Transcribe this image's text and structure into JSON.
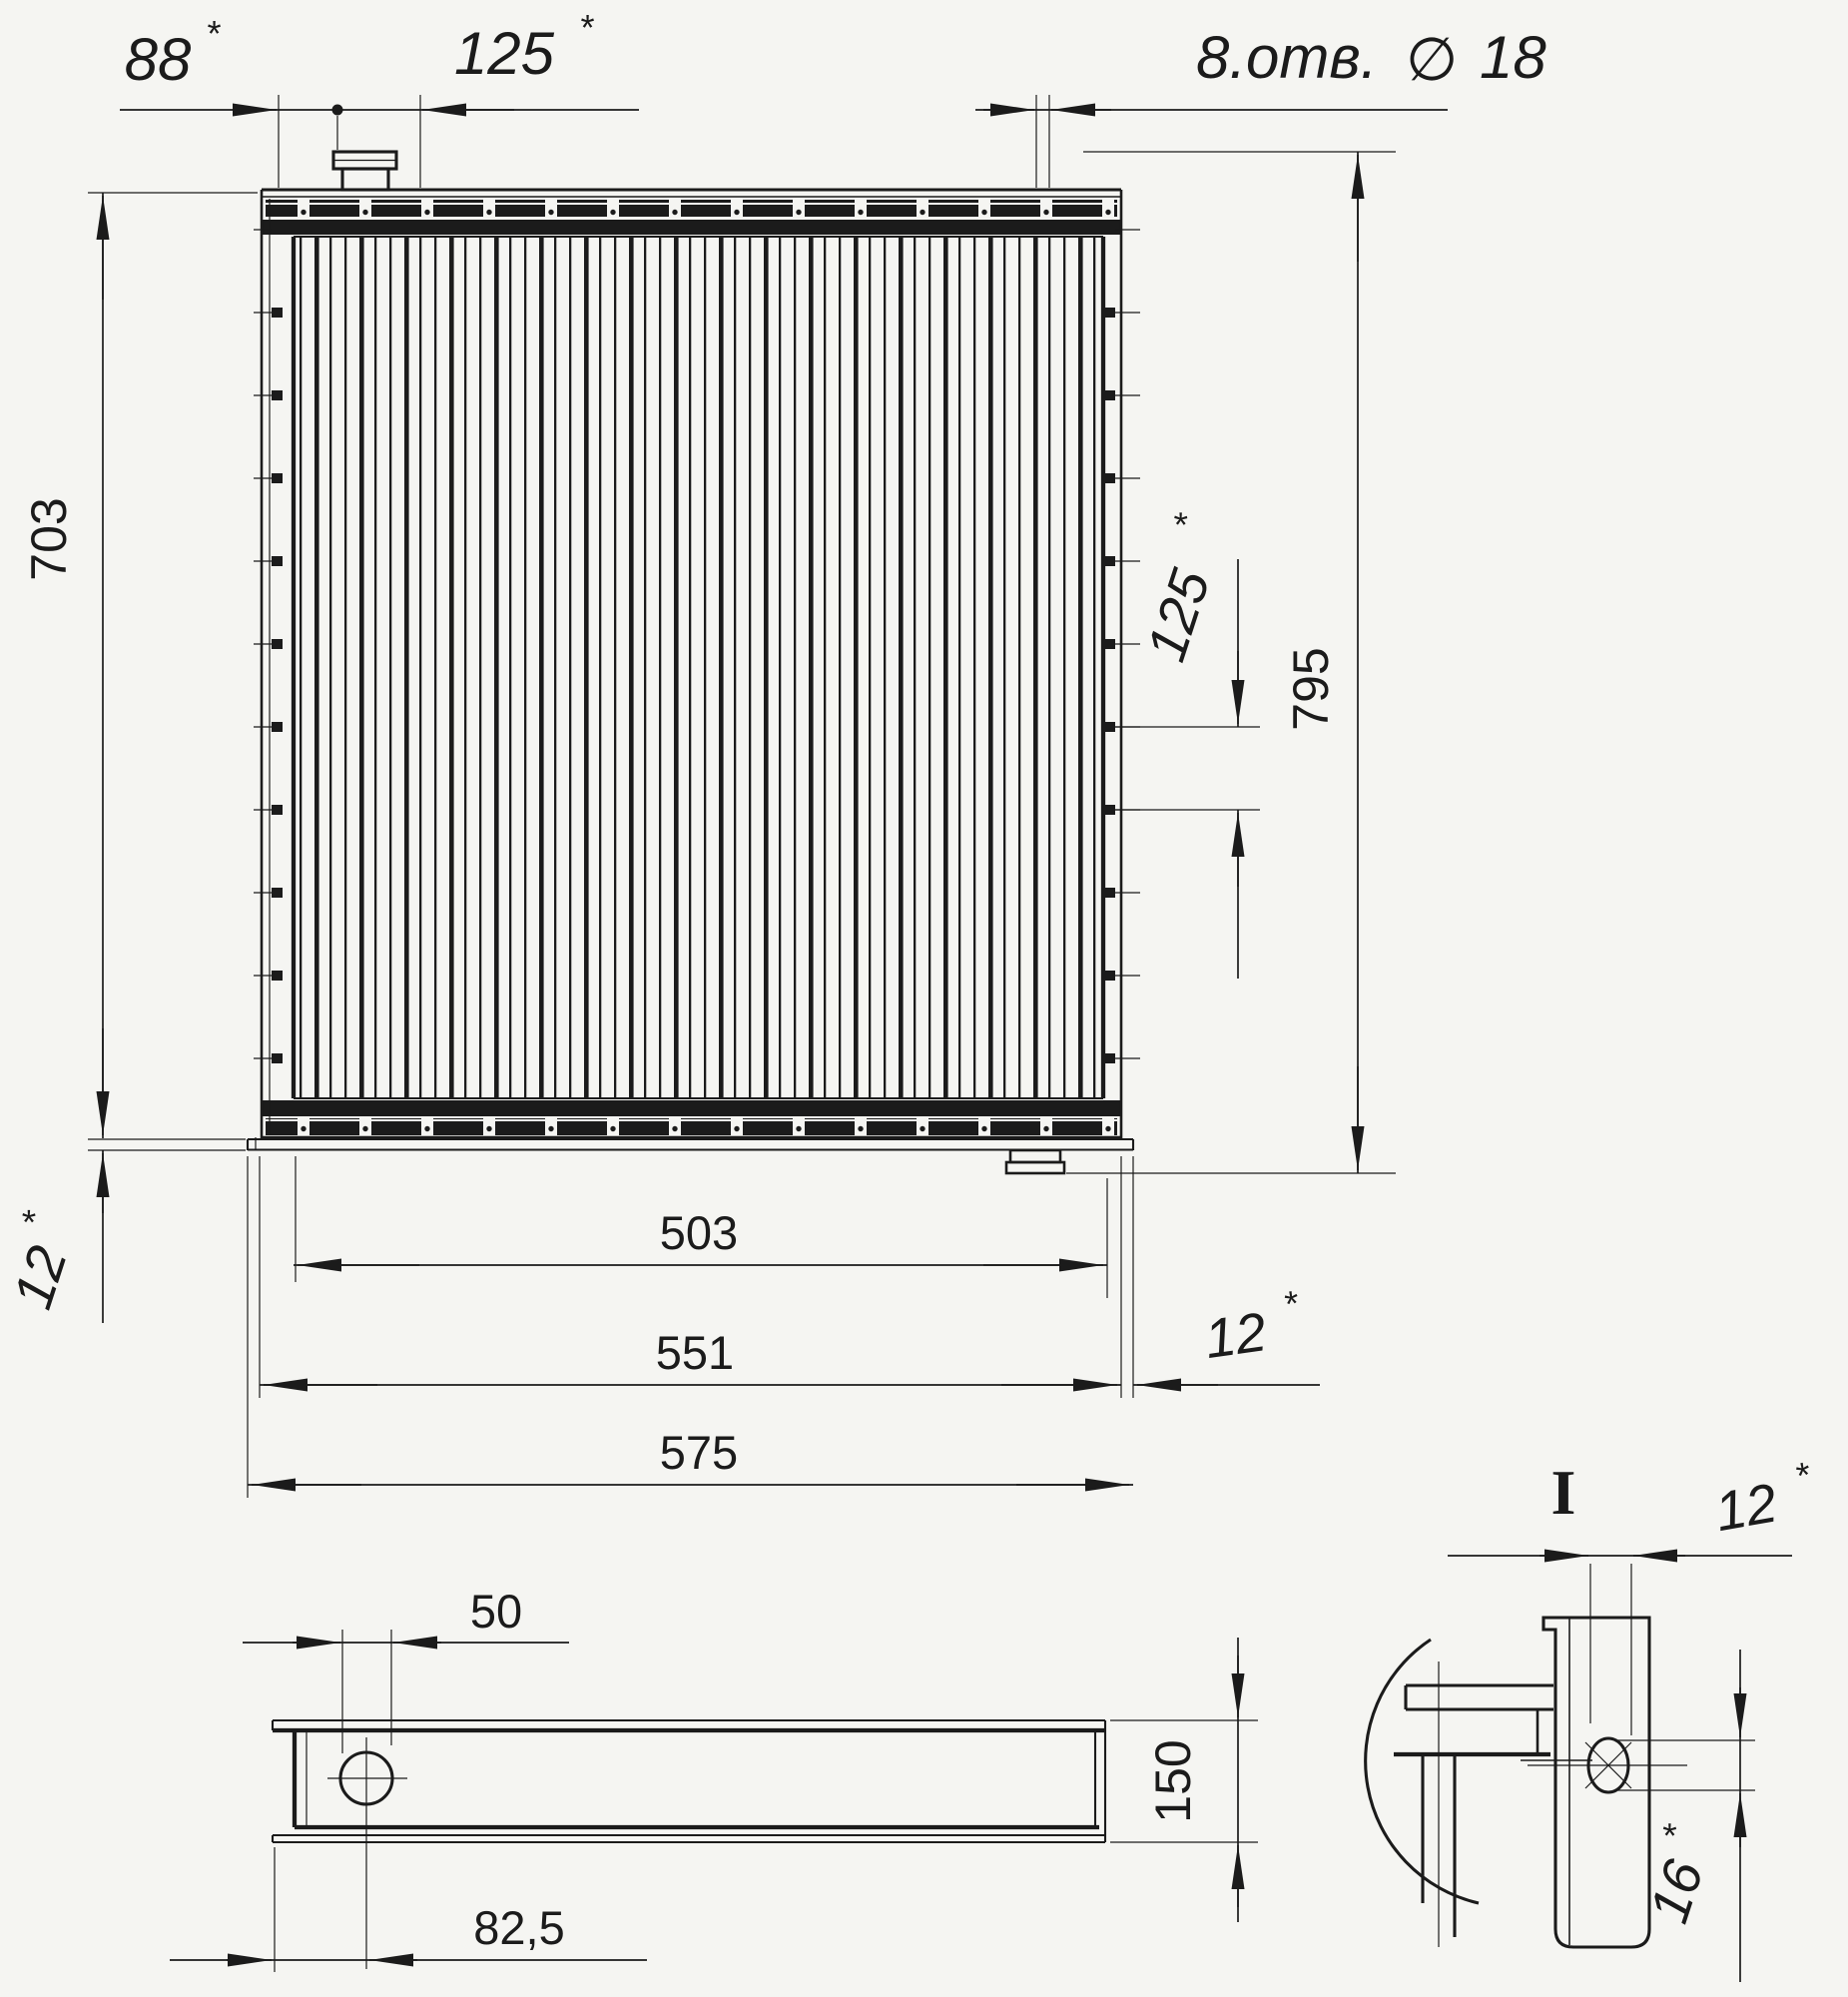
{
  "labels": {
    "d88": "88",
    "d125_top": "125",
    "holes_note": "8.отв.",
    "dia_symbol": "∅",
    "hole_dia": "18",
    "d703": "703",
    "d795": "795",
    "d125_side": "125",
    "d12_left": "12",
    "d503": "503",
    "d551": "551",
    "d575": "575",
    "d12_right": "12",
    "d50": "50",
    "d150": "150",
    "d82_5": "82,5",
    "detail_label": "I",
    "d12_detail": "12",
    "d16": "16",
    "star": "*"
  },
  "colors": {
    "ink": "#1b1b1b",
    "paper": "#f5f5f2"
  }
}
